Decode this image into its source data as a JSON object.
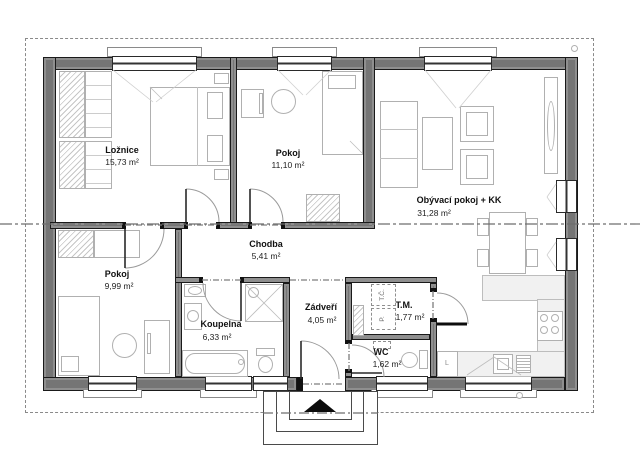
{
  "plan": {
    "rooms": [
      {
        "name": "Ložnice",
        "area": "15,73 m²"
      },
      {
        "name": "Pokoj",
        "area": "11,10 m²"
      },
      {
        "name": "Obývací pokoj + KK",
        "area": "31,28 m²"
      },
      {
        "name": "Pokoj",
        "area": "9,99 m²"
      },
      {
        "name": "Chodba",
        "area": "5,41 m²"
      },
      {
        "name": "Koupelna",
        "area": "6,33 m²"
      },
      {
        "name": "Zádveří",
        "area": "4,05 m²"
      },
      {
        "name": "T.M.",
        "area": "1,77 m²"
      },
      {
        "name": "WC",
        "area": "1,62 m²"
      }
    ],
    "equipment": {
      "fridge": "L",
      "heat_pump": "T.Č.",
      "pump": "P."
    },
    "colors": {
      "wall": "#757575",
      "furniture_line": "#b0b0b0",
      "label": "#111111",
      "dash": "#8a8a8a"
    }
  }
}
